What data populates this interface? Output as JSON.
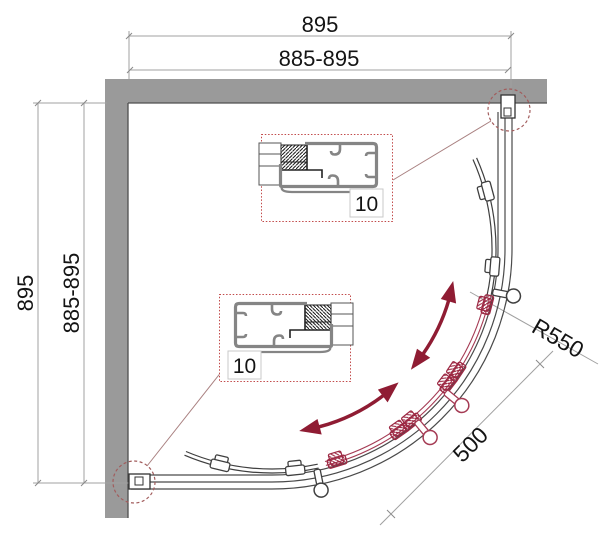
{
  "drawing": {
    "kind": "quadrant-shower-enclosure-plan",
    "dims": {
      "top_outer": "895",
      "top_inner": "885-895",
      "left_outer": "895",
      "left_inner": "885-895",
      "radius_label": "R550",
      "door_label": "500"
    },
    "detail_labels": {
      "top_box": "10",
      "bottom_box": "10"
    },
    "colors": {
      "wall": "#9a9a9a",
      "wall_edge": "#4f4f4f",
      "track": "#4a4a4a",
      "door_black": "#3f3f3f",
      "door_red": "#a53b54",
      "roller_red": "#9c2742",
      "arrow": "#8f1c33",
      "dimension_line": "#a0a0a0",
      "callout": "#a25c5c",
      "detail_box_border": "#c24b4b"
    }
  }
}
